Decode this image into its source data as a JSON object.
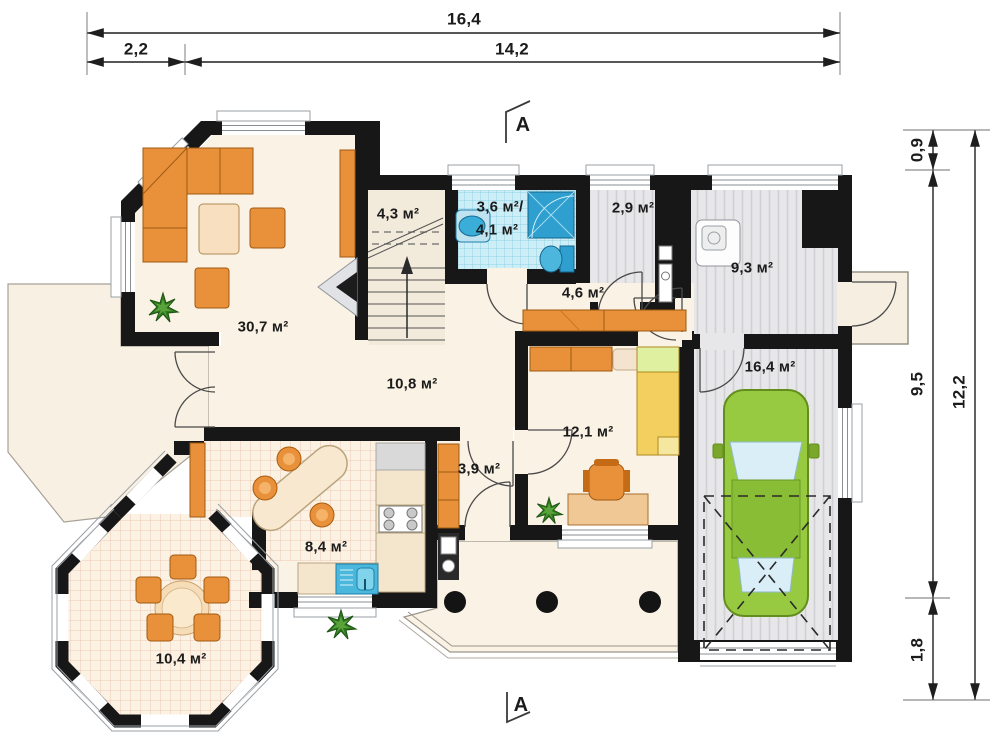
{
  "plan": {
    "section_mark_top": "A",
    "section_mark_bottom": "A",
    "dimensions": {
      "top_total": "16,4",
      "top_left": "2,2",
      "top_right": "14,2",
      "right_top": "0,9",
      "right_middle": "9,5",
      "right_bottom": "1,8",
      "right_total": "12,2"
    },
    "rooms": [
      {
        "id": "living-room",
        "area": "30,7 м²"
      },
      {
        "id": "stair-hall",
        "area": "4,3 м²"
      },
      {
        "id": "bathroom",
        "area": "3,6 м²/",
        "area2": "4,1 м²"
      },
      {
        "id": "pantry",
        "area": "2,9 м²"
      },
      {
        "id": "utility-room",
        "area": "9,3 м²"
      },
      {
        "id": "hallway",
        "area": "4,6 м²"
      },
      {
        "id": "hall",
        "area": "10,8 м²"
      },
      {
        "id": "bedroom",
        "area": "12,1 м²"
      },
      {
        "id": "corridor",
        "area": "3,9 м²"
      },
      {
        "id": "kitchen",
        "area": "8,4 м²"
      },
      {
        "id": "garage",
        "area": "16,4 м²"
      },
      {
        "id": "dining-bay",
        "area": "10,4 м²"
      }
    ],
    "colors": {
      "wall": "#171717",
      "floor_cream": "#faf2e4",
      "furniture_orange": "#e8913a",
      "fixture_blue": "#3aaed8",
      "car_green": "#97ca41",
      "floor_gray": "#e7e7e9"
    }
  }
}
